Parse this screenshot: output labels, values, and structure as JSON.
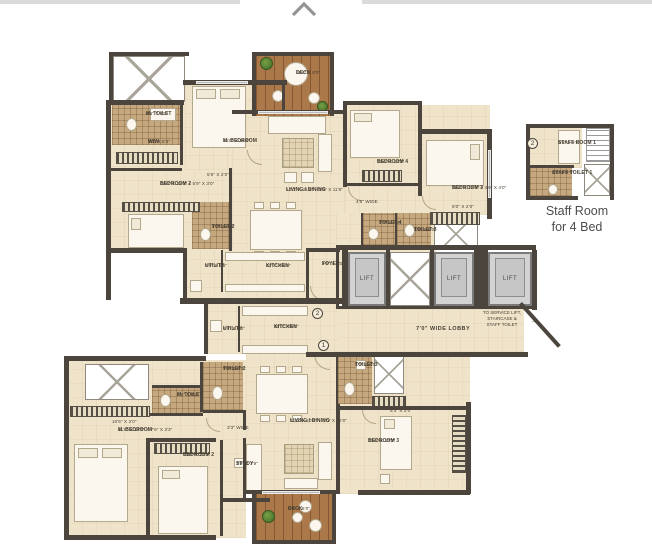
{
  "plan": {
    "unit2": {
      "marker": "2",
      "m_toilet": {
        "name": "M. TOILET",
        "dims": "8'6\" X 8'0\""
      },
      "wiw": {
        "name": "WIW",
        "dims": "9'0\" X 5'3\""
      },
      "m_bedroom": {
        "name": "M. BEDROOM",
        "dims": "12'0\" X 16'6\""
      },
      "bedroom2": {
        "name": "BEDROOM 2",
        "dims": "12'0\" X 11'0\" + 5'9\" X 3'0\""
      },
      "bedroom2_window": "5'6\" X 2'0\"",
      "toilet2": {
        "name": "TOILET 2",
        "dims": "5'0\" X 8'0\""
      },
      "deck": {
        "name": "DECK",
        "dims": "11'2\" X 8'0\""
      },
      "living": {
        "name": "LIVING / DINING",
        "dims": "12'0\" X 21'6\" + 3'6\" X 11'6\""
      },
      "bedroom4": {
        "name": "BEDROOM 4",
        "dims": "10'6\" X 12'0\""
      },
      "passage": "4'6\" WIDE",
      "bedroom3": {
        "name": "BEDROOM 3",
        "dims": "11'0\" X 12'0\" + 4'9\" X 4'0\""
      },
      "bedroom3_window": "8'0\" X 2'0\"",
      "toilet4": {
        "name": "TOILET 4",
        "dims": "8'0\" X 5'0\""
      },
      "toilet3": {
        "name": "TOILET 3",
        "dims": "5'9\" X 8'0\""
      },
      "utility": {
        "name": "UTILITY",
        "dims": "8'0\" X 6'6\""
      },
      "kitchen": {
        "name": "KITCHEN",
        "dims": "12'0\" X 8'0\""
      },
      "foyer": {
        "name": "FOYER",
        "dims": "4'6\" X 9'0\""
      }
    },
    "core": {
      "lift": "LIFT",
      "lobby": "7'0\" WIDE LOBBY",
      "service_note_line1": "TO SERVICE LIFT,",
      "service_note_line2": "STAIRCASE &",
      "service_note_line3": "STAFF TOILET",
      "arrow": "→"
    },
    "unit1": {
      "marker": "1",
      "utility": {
        "name": "UTILITY",
        "dims": "6'0\" X 6'0\""
      },
      "kitchen": {
        "name": "KITCHEN",
        "dims": "10'0\" X 8'0\""
      },
      "toilet2": {
        "name": "TOILET 2",
        "dims": "5'9\" X 8'0\""
      },
      "m_toilet": {
        "name": "M. TOILET",
        "dims": "4'6\" X 8'0\""
      },
      "m_bedroom_window": "10'6\" X 2'0\"",
      "m_bedroom": {
        "name": "M. BEDROOM",
        "dims": "11'6\" X 13'6\" + 7'6\" X 3'3\""
      },
      "passage": "3'3\" WIDE",
      "bedroom2": {
        "name": "BEDROOM 2",
        "dims": "10'6\" X 12'0\""
      },
      "study": {
        "name": "STUDY",
        "dims": "7'9\" X 7'9\""
      },
      "living": {
        "name": "LIVING / DINING",
        "dims": "11'0\" X 20'6\" + 3'0\" X 12'0\""
      },
      "toilet3": {
        "name": "TOILET 3",
        "dims": "5'0\" X 8'0\""
      },
      "bedroom3_window": "5'3\" X 2'0\"",
      "bedroom3": {
        "name": "BEDROOM 3",
        "dims": "10'6\" X 13'0\""
      },
      "deck": {
        "name": "DECK",
        "dims": "8'0\" X 6'0\""
      }
    },
    "staff_detail": {
      "marker": "2",
      "staff_room": {
        "name": "STAFF ROOM 1",
        "dims": "8'6\" X 5'0\""
      },
      "staff_toilet": {
        "name": "STAFF TOILET 1",
        "dims": "5'6\" X 3'9\""
      },
      "caption_line1": "Staff Room",
      "caption_line2": "for 4 Bed"
    },
    "colors": {
      "wall": "#4b453d",
      "floor": "#efe4ca",
      "toilet_tile": "#c6a87f",
      "deck_wood": "#aa7849",
      "lift_fill": "#d3d3d3",
      "plant_green": "#3f6b28"
    }
  }
}
